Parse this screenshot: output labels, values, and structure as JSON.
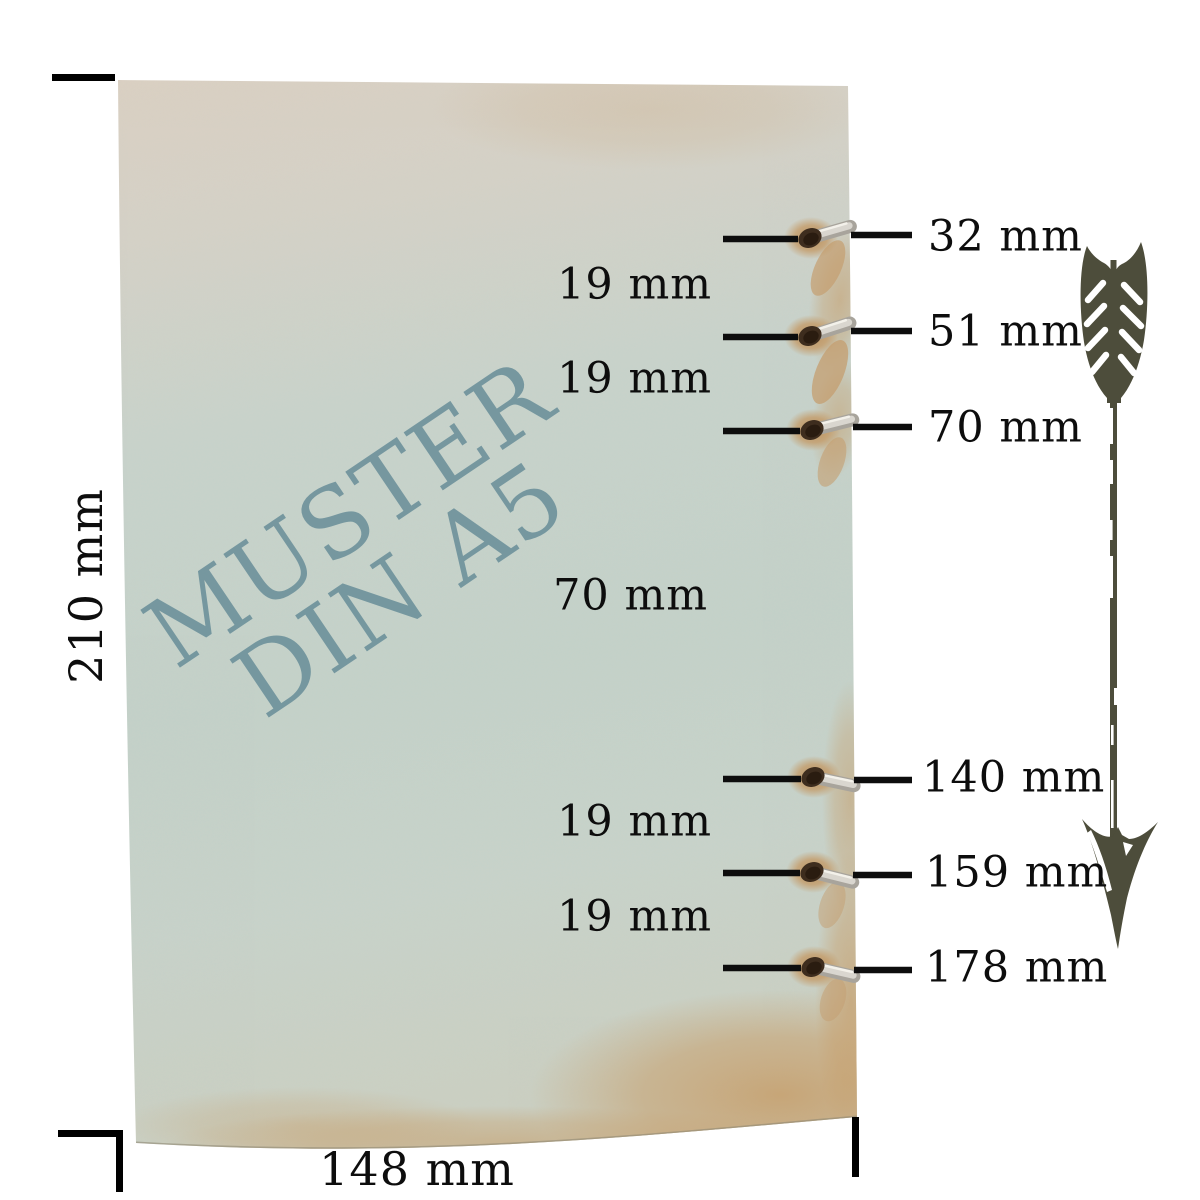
{
  "diagram": {
    "watermark": {
      "line1": "MUSTER",
      "line2": "DIN A5"
    },
    "sheet": {
      "height_label": "210 mm",
      "width_label": "148 mm"
    },
    "holes": [
      {
        "label": "32 mm"
      },
      {
        "label": "51 mm"
      },
      {
        "label": "70 mm"
      },
      {
        "label": "140 mm"
      },
      {
        "label": "159 mm"
      },
      {
        "label": "178 mm"
      }
    ],
    "gaps": [
      {
        "label": "19 mm"
      },
      {
        "label": "19 mm"
      },
      {
        "label": "70 mm"
      },
      {
        "label": "19 mm"
      },
      {
        "label": "19 mm"
      }
    ],
    "icons": {
      "arrow": "down-arrow"
    },
    "colors": {
      "background": "#ffffff",
      "paper_top_beige": "#d9d0c3",
      "paper_green": "#c2d1c9",
      "paper_tan_stain": "#c69a63",
      "watermark_teal": "#6b909a",
      "arrow_olive": "#4d4d3b",
      "line_black": "#0d0d0d",
      "ring_silver": "#d9d6cf",
      "hole_brown": "#3e2d1e"
    }
  }
}
